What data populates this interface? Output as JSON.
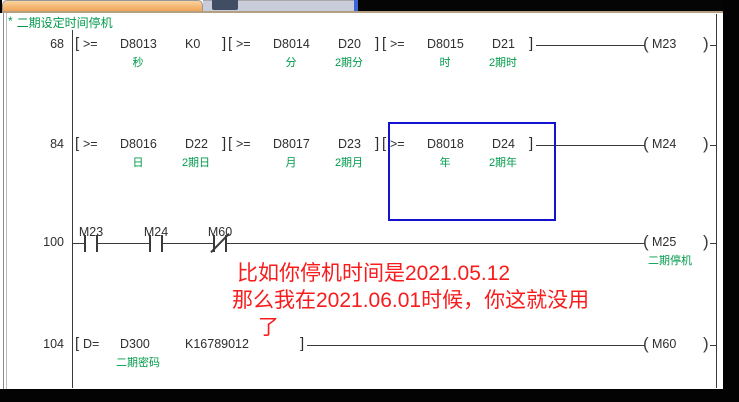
{
  "statement": {
    "prefix": "*",
    "text": "二期设定时间停机"
  },
  "colors": {
    "comment_green": "#009a4a",
    "annotation_red": "#f81c1c",
    "selection_blue": "#1313cd",
    "titlebar_orange": "#efa457"
  },
  "rungs": [
    {
      "number": "68",
      "blocks": [
        {
          "op": ">=",
          "operand1": "D8013",
          "operand2": "K0",
          "comment1": "秒",
          "comment2": ""
        },
        {
          "op": ">=",
          "operand1": "D8014",
          "operand2": "D20",
          "comment1": "分",
          "comment2": "2期分"
        },
        {
          "op": ">=",
          "operand1": "D8015",
          "operand2": "D21",
          "comment1": "时",
          "comment2": "2期时"
        }
      ],
      "coil": {
        "name": "M23",
        "comment": ""
      }
    },
    {
      "number": "84",
      "selected_block": 2,
      "blocks": [
        {
          "op": ">=",
          "operand1": "D8016",
          "operand2": "D22",
          "comment1": "日",
          "comment2": "2期日"
        },
        {
          "op": ">=",
          "operand1": "D8017",
          "operand2": "D23",
          "comment1": "月",
          "comment2": "2期月"
        },
        {
          "op": ">=",
          "operand1": "D8018",
          "operand2": "D24",
          "comment1": "年",
          "comment2": "2期年"
        }
      ],
      "coil": {
        "name": "M24",
        "comment": ""
      }
    },
    {
      "number": "100",
      "contacts": [
        {
          "name": "M23",
          "type": "NO"
        },
        {
          "name": "M24",
          "type": "NO"
        },
        {
          "name": "M60",
          "type": "NC"
        }
      ],
      "coil": {
        "name": "M25",
        "comment": "二期停机"
      }
    },
    {
      "number": "104",
      "blocks": [
        {
          "op": "D=",
          "operand1": "D300",
          "operand2": "K16789012",
          "comment1": "二期密码",
          "comment2": ""
        }
      ],
      "coil": {
        "name": "M60",
        "comment": ""
      }
    }
  ],
  "annotation": {
    "lines": [
      "比如你停机时间是2021.05.12",
      "那么我在2021.06.01时候，你这就没用",
      "了"
    ]
  }
}
